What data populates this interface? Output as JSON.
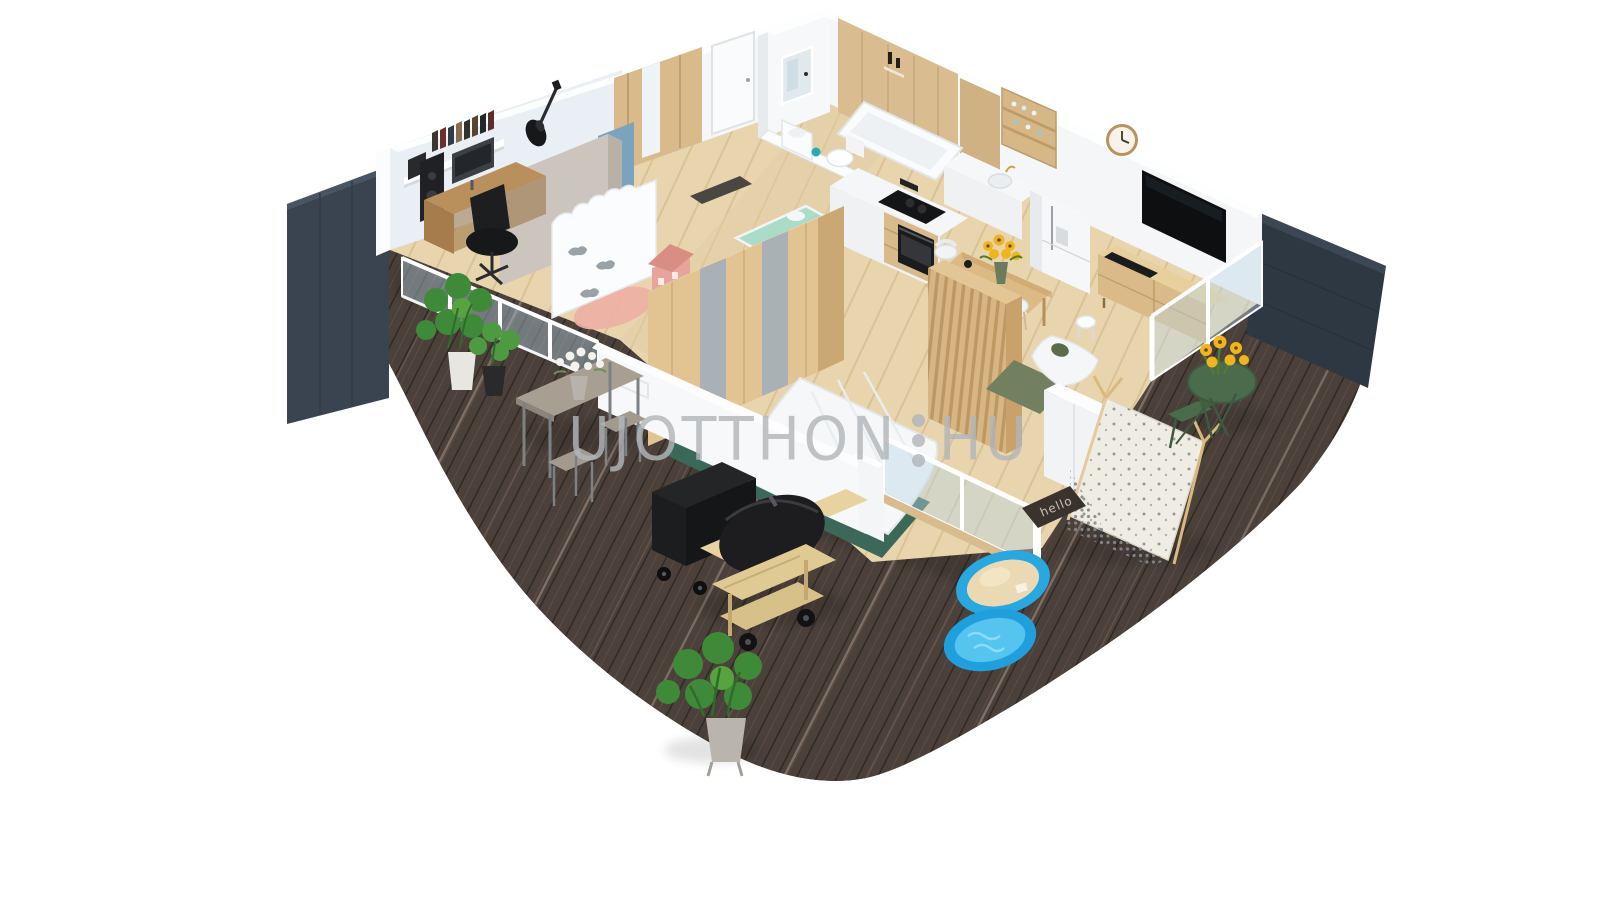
{
  "watermark": {
    "brand_left": "UJOTTHON",
    "brand_right": "HU",
    "separator": "three-vertical-dots",
    "color": "#b1b6ba"
  },
  "doormat": {
    "text": "hello"
  },
  "palette": {
    "background": "#ffffff",
    "terrace_wood": "#4b403a",
    "terrace_gap": "#2e2823",
    "terrace_highlight": "#907f72",
    "panel_left_navy": "#3a4450",
    "panel_right_navy": "#2e3842",
    "wall_white": "#f5f6f8",
    "wall_shade": "#e8ebee",
    "office_wall_blue": "#e9eff5",
    "accent_blue_wall": "#7ba3c0",
    "pink_wall": "#f5dcd9",
    "salmon_rug": "#edb1a4",
    "taupe_cabinet": "#ccc5bd",
    "oak_wood": "#dcbd8d",
    "floor_oak": "#e8d5ae",
    "appliance_black": "#141517",
    "tv_black": "#0e0f11",
    "rug_green": "#3c685a",
    "sage_green": "#72805f",
    "teal_bedding": "#2e6e72",
    "mint_blanket": "#aadcc9",
    "teepee_fabric": "#efede3",
    "shell_blue": "#28a7e0",
    "sand": "#ead9b2",
    "water_blue": "#55c4ef",
    "bistro_green": "#4a6b4c",
    "sunflower_yellow": "#f0b41f",
    "plant_green": "#3f8a38",
    "mat_dark": "#3a332d",
    "mat_text": "#c9c0b2",
    "watermark_gray": "#b1b6ba"
  },
  "scene": {
    "description": "3D isometric cutaway render of a furnished apartment floor plan with a wrap-around dark wood terrace on white background",
    "rooms": [
      "home-office-music-room",
      "kids-room",
      "hallway",
      "bathroom",
      "wc",
      "kitchen",
      "dining-area",
      "living-room",
      "bedroom",
      "terrace"
    ],
    "objects": [
      "wall-guitar",
      "book-shelf",
      "office-desk",
      "office-chair",
      "speaker",
      "taupe-cabinet",
      "cloud-wardrobe",
      "doll-house",
      "toddler-bed",
      "oak-wardrobe-gray-stripes",
      "hall-wardrobe",
      "entry-door",
      "lit-mirror",
      "washbasin",
      "toilet",
      "bathtub",
      "kitchen-peninsula",
      "cooktop",
      "oven",
      "kitchen-sink",
      "fridge",
      "open-shelf-cabinet",
      "wall-clock",
      "wall-tv",
      "tv-console",
      "dining-table",
      "sunflower-vase",
      "dining-chairs",
      "slat-headboard",
      "double-bed",
      "green-rug",
      "bedside-table",
      "bedroom-wardrobe",
      "glass-balustrade",
      "sliding-glass-door",
      "bar-table",
      "bar-stools",
      "flower-bouquet",
      "black-cart",
      "barrel-grill",
      "monstera-plants",
      "shell-sandbox-sand",
      "shell-pool-water",
      "play-teepee",
      "bistro-table",
      "bistro-chair",
      "hello-doormat",
      "navy-privacy-panels"
    ]
  }
}
